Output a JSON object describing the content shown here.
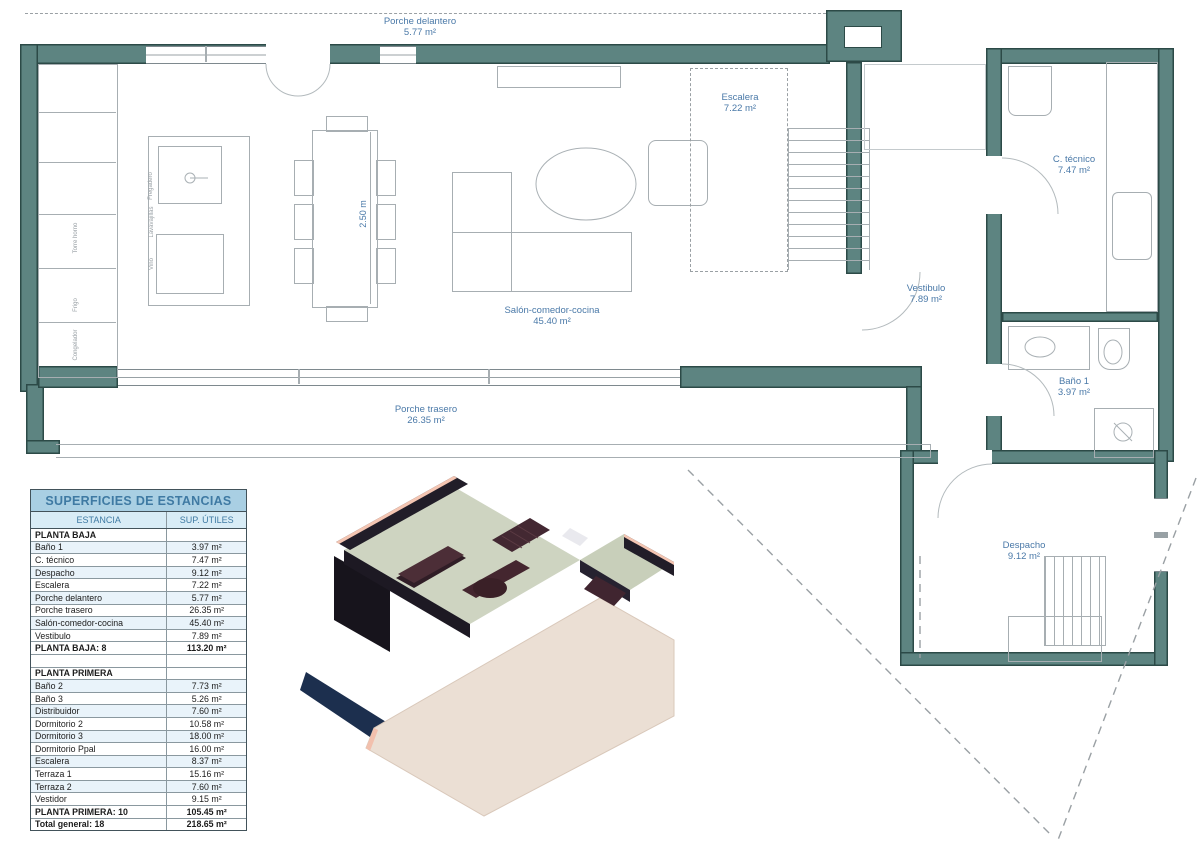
{
  "plan": {
    "labels": {
      "porche_delantero": {
        "name": "Porche delantero",
        "area": "5.77 m²"
      },
      "escalera": {
        "name": "Escalera",
        "area": "7.22 m²"
      },
      "c_tecnico": {
        "name": "C. técnico",
        "area": "7.47 m²"
      },
      "vestibulo": {
        "name": "Vestibulo",
        "area": "7.89 m²"
      },
      "salon": {
        "name": "Salón-comedor-cocina",
        "area": "45.40 m²"
      },
      "porche_trasero": {
        "name": "Porche trasero",
        "area": "26.35 m²"
      },
      "bano1": {
        "name": "Baño 1",
        "area": "3.97 m²"
      },
      "despacho": {
        "name": "Despacho",
        "area": "9.12 m²"
      }
    },
    "dimension": "2.50 m",
    "appliances": {
      "fregadero": "Fregadero",
      "lavavajillas": "Lavavajillas",
      "vino": "Vino",
      "torre_horno": "Torre horno",
      "frigo": "Frigo",
      "congelador": "Congelador"
    }
  },
  "table": {
    "title": "SUPERFICIES DE ESTANCIAS",
    "col_estancia": "ESTANCIA",
    "col_sup": "SUP. ÚTILES",
    "rows": [
      {
        "type": "section",
        "name": "PLANTA BAJA",
        "value": ""
      },
      {
        "type": "data",
        "name": "Baño 1",
        "value": "3.97 m²"
      },
      {
        "type": "data",
        "name": "C. técnico",
        "value": "7.47 m²"
      },
      {
        "type": "data",
        "name": "Despacho",
        "value": "9.12 m²"
      },
      {
        "type": "data",
        "name": "Escalera",
        "value": "7.22 m²"
      },
      {
        "type": "data",
        "name": "Porche delantero",
        "value": "5.77 m²"
      },
      {
        "type": "data",
        "name": "Porche trasero",
        "value": "26.35 m²"
      },
      {
        "type": "data",
        "name": "Salón-comedor-cocina",
        "value": "45.40 m²"
      },
      {
        "type": "data",
        "name": "Vestibulo",
        "value": "7.89 m²"
      },
      {
        "type": "total",
        "name": "PLANTA BAJA: 8",
        "value": "113.20 m²"
      },
      {
        "type": "spacer",
        "name": "",
        "value": ""
      },
      {
        "type": "section",
        "name": "PLANTA PRIMERA",
        "value": ""
      },
      {
        "type": "data",
        "name": "Baño 2",
        "value": "7.73 m²"
      },
      {
        "type": "data",
        "name": "Baño 3",
        "value": "5.26 m²"
      },
      {
        "type": "data",
        "name": "Distribuidor",
        "value": "7.60 m²"
      },
      {
        "type": "data",
        "name": "Dormitorio 2",
        "value": "10.58 m²"
      },
      {
        "type": "data",
        "name": "Dormitorio 3",
        "value": "18.00 m²"
      },
      {
        "type": "data",
        "name": "Dormitorio Ppal",
        "value": "16.00 m²"
      },
      {
        "type": "data",
        "name": "Escalera",
        "value": "8.37 m²"
      },
      {
        "type": "data",
        "name": "Terraza 1",
        "value": "15.16 m²"
      },
      {
        "type": "data",
        "name": "Terraza 2",
        "value": "7.60 m²"
      },
      {
        "type": "data",
        "name": "Vestidor",
        "value": "9.15 m²"
      },
      {
        "type": "total",
        "name": "PLANTA PRIMERA: 10",
        "value": "105.45 m²"
      },
      {
        "type": "total",
        "name": "Total general: 18",
        "value": "218.65 m²"
      }
    ]
  },
  "colors": {
    "wall": "#5d8481",
    "wall_edge": "#2c4a47",
    "line": "#a7aeb2",
    "label": "#4a79a8",
    "dash": "#9aa0a4",
    "table_title_bg": "#a9cfe3",
    "table_head_bg": "#d8ecf6",
    "table_blue_text": "#3f7aa3",
    "table_row_alt": "#e9f3fa",
    "table_border": "#42525a",
    "table_grid": "#8a989f",
    "render_slab": "#ebdfd4",
    "render_floor": "#ced4c1",
    "render_wall": "#211d28",
    "render_coral": "#f4c5b2",
    "render_furniture": "#44262f",
    "render_shadow": "#1c2f4e"
  }
}
